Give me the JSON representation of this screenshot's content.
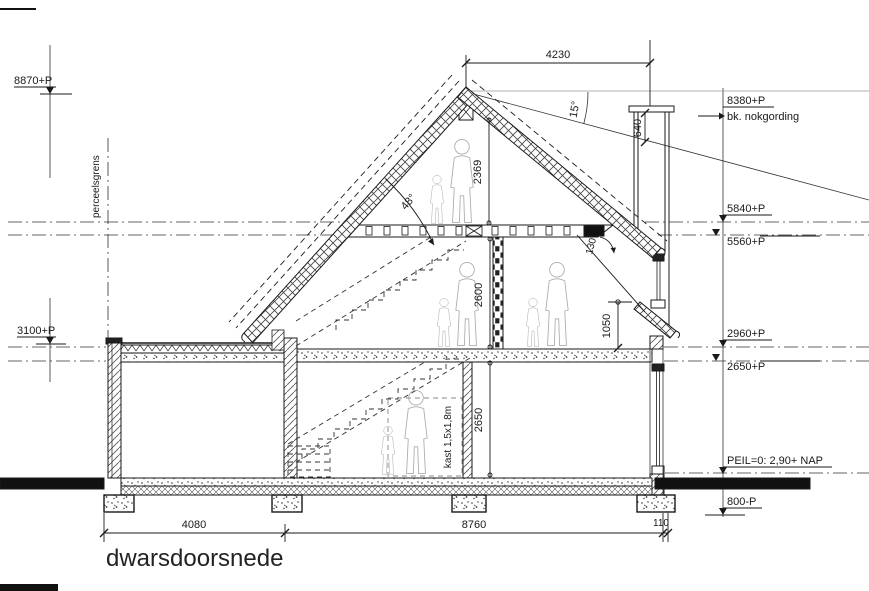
{
  "title": "dwarsdoorsnede",
  "levels_right": {
    "l8380": "8380+P",
    "nok": "bk. nokgording",
    "l5840": "5840+P",
    "l5560": "5560+P",
    "l2960": "2960+P",
    "l2650": "2650+P",
    "peil": "PEIL=0:  2,90+ NAP",
    "l800": "800-P"
  },
  "levels_left": {
    "l8870": "8870+P",
    "l3100": "3100+P"
  },
  "dims": {
    "top_width": "4230",
    "bottom_left": "4080",
    "bottom_mid": "8760",
    "bottom_right": "110",
    "attic_height": "2369",
    "first_floor_height": "2600",
    "ground_floor_height": "2650",
    "knee_height": "1050",
    "chimney_height": "640",
    "roof_gap": "130"
  },
  "angles": {
    "right_roof": "15°",
    "left_roof": "48°"
  },
  "annotations": {
    "boundary": "perceelsgrens",
    "closet": "kast 1,5x1,8m"
  }
}
